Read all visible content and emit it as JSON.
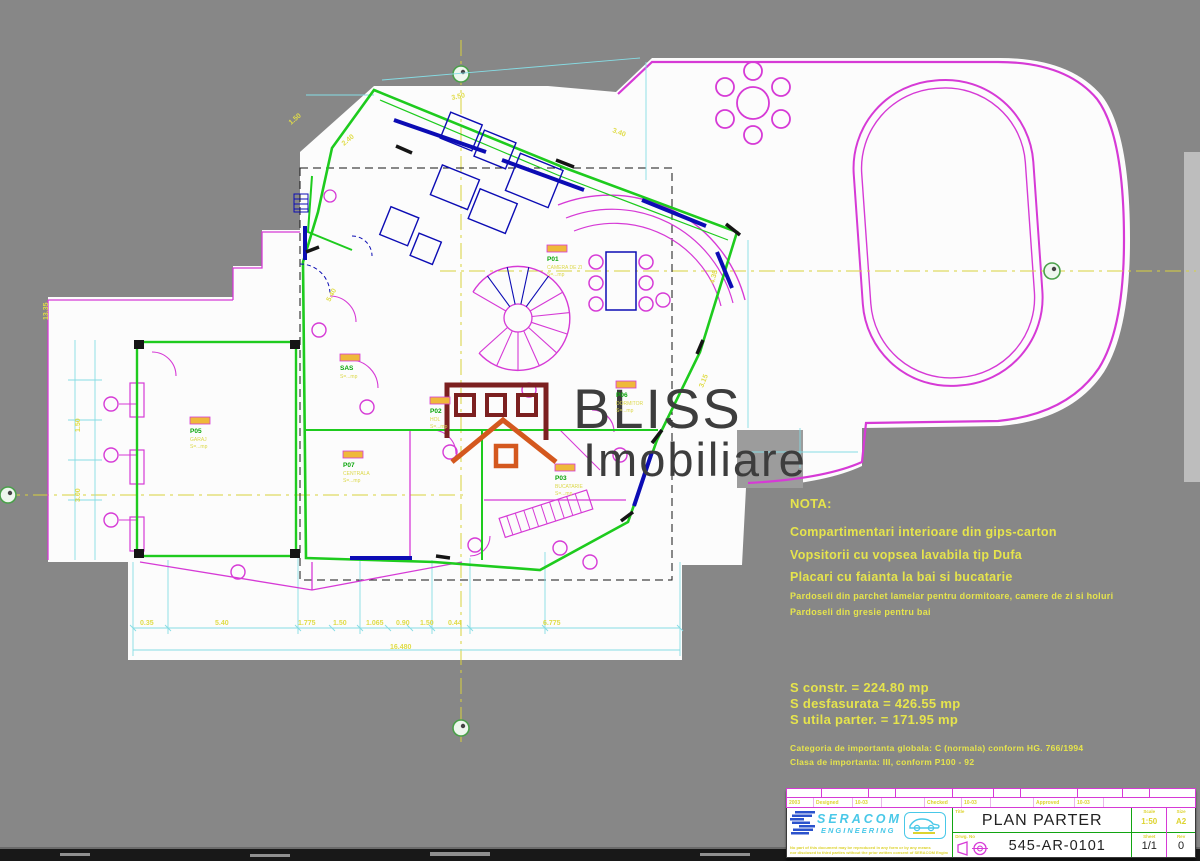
{
  "watermark": {
    "brand": "BLISS",
    "brand2": "Imobiliare"
  },
  "notes": {
    "heading": "NOTA:",
    "line1": "Compartimentari interioare din gips-carton",
    "line2": "Vopsitorii cu vopsea lavabila tip Dufa",
    "line3": "Placari cu faianta la bai si bucatarie",
    "line4": "Pardoseli din parchet lamelar pentru dormitoare, camere de zi si holuri",
    "line5": "Pardoseli din gresie pentru bai"
  },
  "areas": {
    "built": "S constr. = 224.80 mp",
    "unfolded": "S desfasurata = 426.55 mp",
    "usable": "S utila parter. = 171.95 mp"
  },
  "importance": {
    "line1": "Categoria de importanta globala: C (normala) conform HG. 766/1994",
    "line2": "Clasa de importanta: III, conform P100 - 92"
  },
  "title_block": {
    "company": "SERACOM",
    "company2": "ENGINEERING",
    "year": "2003",
    "approvals": [
      {
        "label": "Designed",
        "value": "10-03"
      },
      {
        "label": "Checked",
        "value": "10-03"
      },
      {
        "label": "Approved",
        "value": "10-03"
      }
    ],
    "disclaimer1": "No part of this document may be reproduced in any form or by any means",
    "disclaimer2": "nor disclosed to third parties without the prior written consent of SERACOM Engineering",
    "title_label": "Title",
    "title": "PLAN PARTER",
    "drawing_label": "Drwg. No",
    "drawing_no": "545-AR-0101",
    "scale_label": "Scale",
    "scale": "1:50",
    "size_label": "Size",
    "size": "A2",
    "sheet_label": "Sheet",
    "sheet": "1/1",
    "rev_label": "Rev",
    "rev": "0"
  },
  "plan": {
    "rooms": [
      {
        "code": "P01",
        "name": "CAMERA DE ZI",
        "area": "S=...mp"
      },
      {
        "code": "SAS",
        "name": "",
        "area": "S=...mp"
      },
      {
        "code": "P02",
        "name": "HOL",
        "area": "S=...mp"
      },
      {
        "code": "P06",
        "name": "DORMITOR",
        "area": "S=...mp"
      },
      {
        "code": "P07",
        "name": "CENTRALA",
        "area": "S=...mp"
      },
      {
        "code": "P03",
        "name": "BUCATARIE",
        "area": "S=...mp"
      },
      {
        "code": "P05",
        "name": "GARAJ",
        "area": "S=...mp"
      }
    ],
    "dim_labels": [
      {
        "t": "3.50"
      },
      {
        "t": "3.40"
      },
      {
        "t": "2.40"
      },
      {
        "t": "1.50"
      },
      {
        "t": "4.35"
      },
      {
        "t": "3.15"
      },
      {
        "t": "13.35"
      },
      {
        "t": "0.35"
      },
      {
        "t": "5.40"
      },
      {
        "t": "1.775"
      },
      {
        "t": "1.50"
      },
      {
        "t": "1.065"
      },
      {
        "t": "0.90"
      },
      {
        "t": "1.50"
      },
      {
        "t": "0.44"
      },
      {
        "t": "6.775"
      },
      {
        "t": "16.480"
      },
      {
        "t": "1.50"
      },
      {
        "t": "3.00"
      },
      {
        "t": "5.40"
      }
    ]
  },
  "colors": {
    "cad_magenta": "#d63ad6",
    "cad_green": "#1ecb1e",
    "cad_cyan": "#86dce4",
    "cad_yellow": "#e6e44c",
    "cad_navy": "#0c0cb4",
    "paper_white": "#fcfcfc",
    "background_gray": "#878787",
    "logo_maroon": "#7c2020",
    "logo_orange": "#d4581e",
    "seracom_cyan": "#49c8e8"
  }
}
